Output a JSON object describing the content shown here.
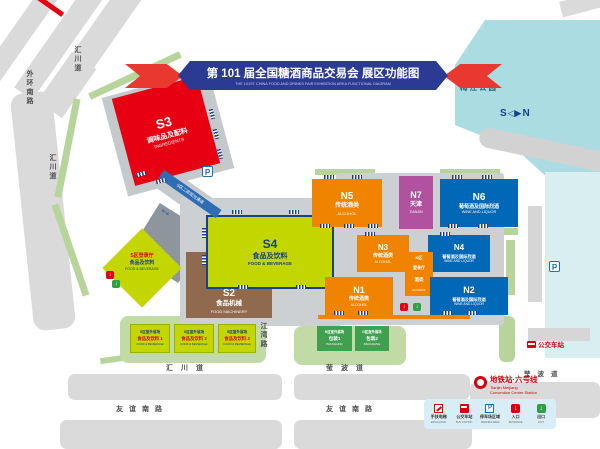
{
  "banner": {
    "title_zh": "第 101 届全国糖酒商品交易会  展区功能图",
    "title_en": "THE 101ST CHINA FOOD AND DRINKS FAIR  EXHIBITION AREA FUNCTIONAL DIAGRAM"
  },
  "park": {
    "label": "梅江公园"
  },
  "compass": {
    "s": "S",
    "n": "N"
  },
  "halls": {
    "s3": {
      "code": "S3",
      "zh": "调味品及配料",
      "en": "INGREDIENTS"
    },
    "s4": {
      "code": "S4",
      "zh": "食品及饮料",
      "en": "FOOD & BEVERAGE"
    },
    "s2": {
      "code": "S2",
      "zh": "食品机械",
      "en": "FOOD MACHINERY"
    },
    "n5": {
      "code": "N5",
      "zh": "传统酒类",
      "en": "ALCOHOL"
    },
    "n7": {
      "code": "N7",
      "zh": "天津",
      "en": "TIANJIN"
    },
    "n6": {
      "code": "N6",
      "zh": "葡萄酒及国际烈酒",
      "en": "WINE AND LIQUOR"
    },
    "n3": {
      "code": "N3",
      "zh": "传统酒类",
      "en": "ALCOHOL"
    },
    "n4": {
      "code": "N4",
      "zh": "葡萄酒及国际烈酒",
      "en": "WINE AND LIQUOR"
    },
    "n1": {
      "code": "N1",
      "zh": "传统酒类",
      "en": "ALCOHOL"
    },
    "n2": {
      "code": "N2",
      "zh": "葡萄酒及国际烈酒",
      "en": "WINE AND LIQUOR"
    }
  },
  "registration": {
    "s": {
      "line1": "S区登录厅",
      "line2": "食品及饮料",
      "line3": "FOOD & BEVERAGE"
    },
    "n": {
      "line1": "N区",
      "line2": "登录厅",
      "line3": "酒类",
      "line4": "ALCOHOL"
    }
  },
  "walkway": {
    "label": "S区二层观光通道"
  },
  "outdoor": {
    "s1": {
      "line1": "S区室外展场",
      "line2": "食品及饮料 1",
      "line3": "FOOD & BEVERAGE"
    },
    "s2": {
      "line1": "S区室外展场",
      "line2": "食品及饮料 2",
      "line3": "FOOD & BEVERAGE"
    },
    "s3": {
      "line1": "S区室外展场",
      "line2": "食品及饮料 3",
      "line3": "FOOD & BEVERAGE"
    },
    "n1": {
      "line1": "N区室外展场",
      "line2": "包装1",
      "line3": "PACKAGING"
    },
    "n2": {
      "line1": "N区室外展场",
      "line2": "包装2",
      "line3": "PACKAGING"
    }
  },
  "roads": {
    "waihuan": "外环南路",
    "huichuan_top": "汇川道",
    "huichuan_mid": "汇川道",
    "huichuan_bottom": "汇川道",
    "jiangwan": "江湾路",
    "yingbo_bottom": "莹波道",
    "yingbo_right": "莹波道",
    "youyi_left": "友谊南路",
    "youyi_right": "友谊南路"
  },
  "markers": {
    "parking": "P",
    "bus_stop": "公交车站"
  },
  "metro": {
    "station_zh": "地铁站·六号线",
    "station_en1": "Tianjin Meijiang",
    "station_en2": "Convention Center Station"
  },
  "legend": {
    "items": [
      {
        "zh": "手扶电梯",
        "en": "ESCALATOR"
      },
      {
        "zh": "公交车站",
        "en": "BUS STATION"
      },
      {
        "zh": "停车场区域",
        "en": "PARKING AREA"
      },
      {
        "zh": "入口",
        "en": "ENTRANCE"
      },
      {
        "zh": "出口",
        "en": "EXIT"
      }
    ]
  }
}
